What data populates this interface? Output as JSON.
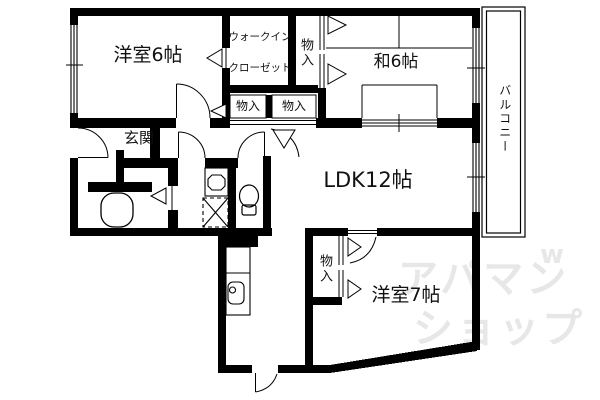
{
  "title": "apartment-floorplan",
  "rooms": {
    "bedroom6": "洋室6帖",
    "japanese_room": "和6帖",
    "ldk": "LDK12帖",
    "bedroom7": "洋室7帖",
    "genkan": "玄関",
    "balcony": "バルコニー",
    "storage_top": "物入",
    "storage_a": "物入",
    "storage_b": "物入",
    "storage_bottom": "物入"
  },
  "wic": {
    "line1": "ウォークイン",
    "line2": "クローゼット"
  },
  "watermark": {
    "line1": "アパマン",
    "line2": "ショップ",
    "mark": "w"
  },
  "colors": {
    "wall": "#000000",
    "floor": "#ffffff",
    "watermark": "#e7e7e7"
  }
}
